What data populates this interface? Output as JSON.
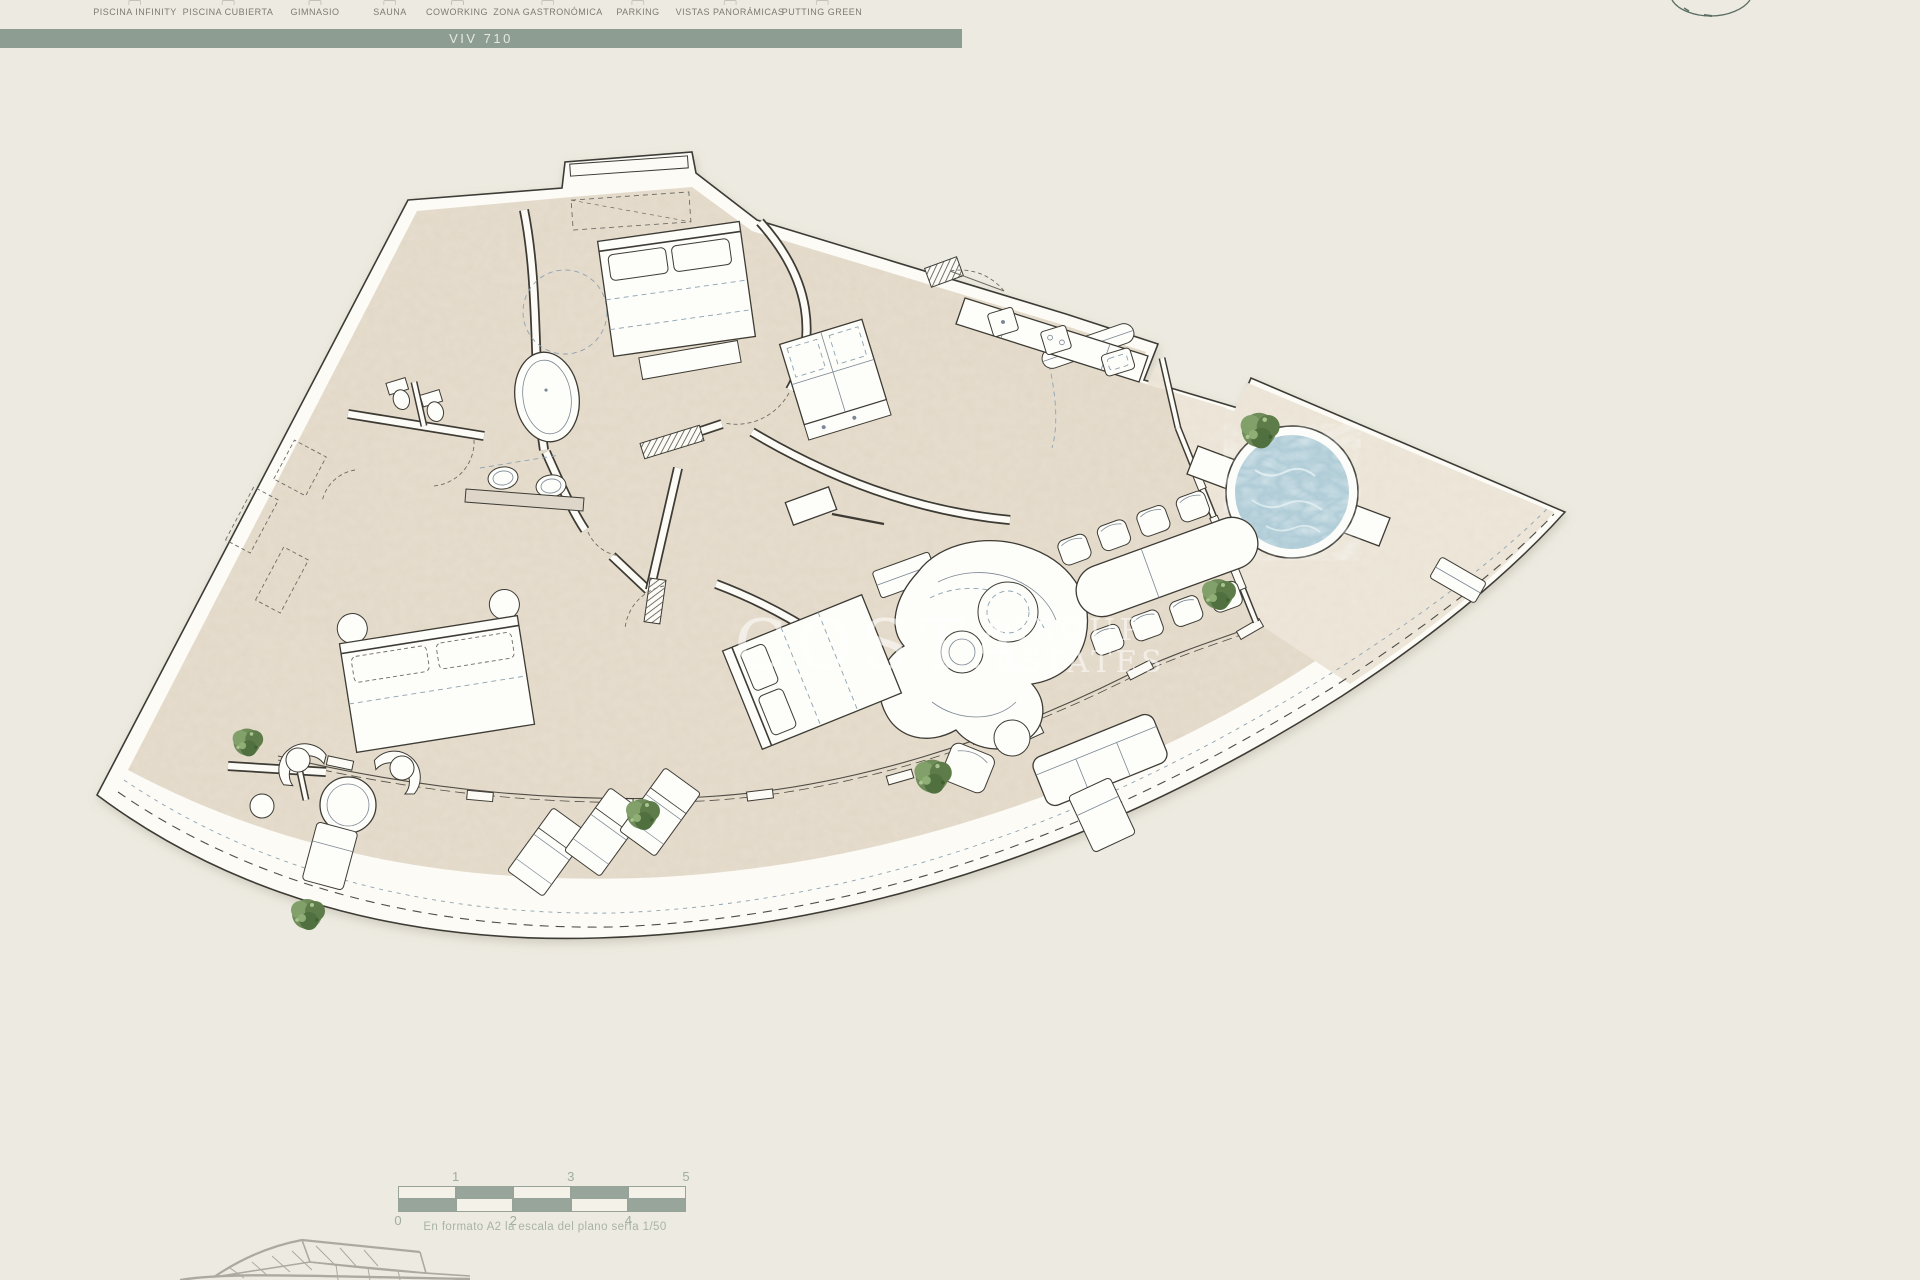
{
  "header": {
    "amenities": [
      "PISCINA INFINITY",
      "PISCINA CUBIERTA",
      "GIMNASIO",
      "SAUNA",
      "COWORKING",
      "ZONA GASTRONÓMICA",
      "PARKING",
      "VISTAS PANORÁMICAS",
      "PUTTING GREEN"
    ],
    "icons": [
      "piscina-infinity-icon",
      "piscina-cubierta-icon",
      "gimnasio-icon",
      "sauna-icon",
      "coworking-icon",
      "zona-gastronomica-icon",
      "parking-icon",
      "vistas-panoramicas-icon",
      "putting-green-icon"
    ]
  },
  "title_bar": {
    "label": "VIV 710"
  },
  "watermark": {
    "line1": "COSTA",
    "line2": "GROUP",
    "line3": "ESTATES"
  },
  "scale_bar": {
    "top_labels": [
      "1",
      "3",
      "5"
    ],
    "bottom_labels": [
      "0",
      "2",
      "4"
    ],
    "caption": "En formato A2 la escala del plano sería 1/50"
  },
  "colors": {
    "background": "#edebe1",
    "accent_sage": "#8e9d91",
    "floor": "#e7decf",
    "terrace": "#efe9dd",
    "outline": "#3d3b34",
    "water": "#b4cdd7",
    "plant": "#5d7c49"
  }
}
